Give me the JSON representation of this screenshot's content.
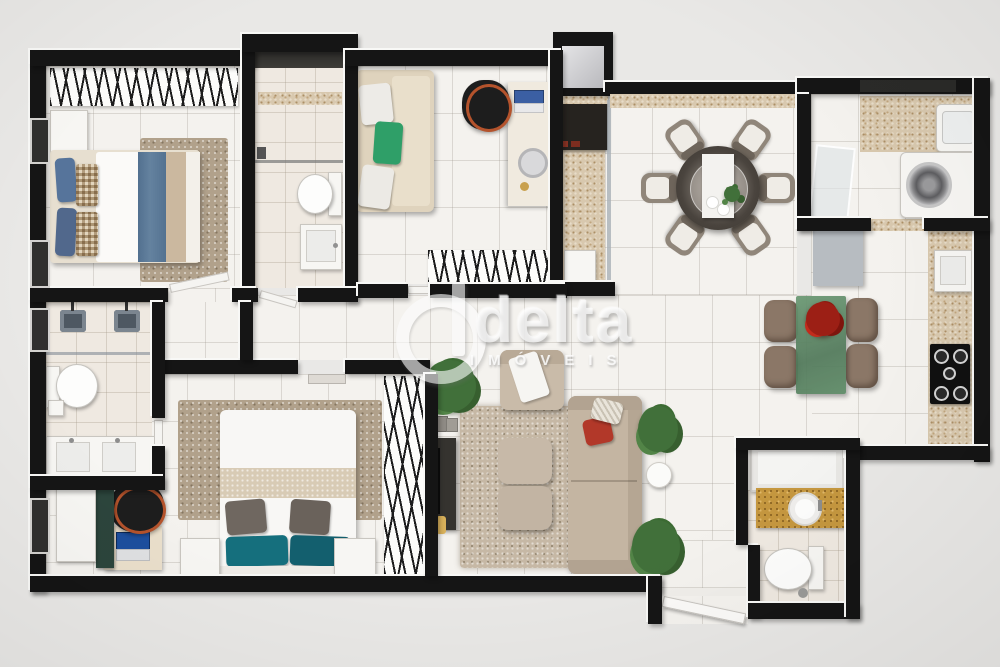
{
  "watermark": {
    "brand": "delta",
    "subtitle": "IMÓVEIS"
  },
  "palette": {
    "background": "#e9e8e6",
    "walls": "#151515",
    "floor_tile": "#f4f2ee",
    "bath_tile": "#efe9e1",
    "granite_counter": "#d8c8ae",
    "wood_vanity": "#c5973f",
    "rug_brown": "#b1a18b",
    "bedding_blue": "#5d7a99",
    "pillow_green": "#2f9f68",
    "pillow_teal": "#156f7d",
    "island_green": "#5d8a66",
    "flowers_red": "#9c1f15",
    "sofa_beige": "#c4b5a2",
    "office_chair_black": "#1d1d1d",
    "chair_strap_orange": "#b4532c"
  },
  "floor_plan": {
    "type": "apartment-3d-top-down-render",
    "rooms": [
      {
        "name": "bedroom-1",
        "furniture": [
          "double-bed-blue-bedding",
          "stick-headboard-panel",
          "wardrobe",
          "shag-rug"
        ]
      },
      {
        "name": "bathroom-1",
        "furniture": [
          "closet-niche",
          "shower",
          "toilet",
          "square-sink"
        ]
      },
      {
        "name": "office-guest-room",
        "furniture": [
          "daybed-sofa-green-pillow",
          "desk-with-laptop",
          "black-office-chair",
          "stick-bench"
        ]
      },
      {
        "name": "gourmet-balcony",
        "furniture": [
          "grill-counter",
          "service-box"
        ]
      },
      {
        "name": "dining-room",
        "furniture": [
          "round-dining-table",
          "six-upholstered-chairs",
          "table-runner",
          "plates",
          "small-plant"
        ]
      },
      {
        "name": "laundry-room",
        "furniture": [
          "washing-machine",
          "tank-sink",
          "granite-counter",
          "glass-door"
        ]
      },
      {
        "name": "kitchen",
        "furniture": [
          "gray-cabinet",
          "granite-counter-with-sink",
          "five-burner-cooktop",
          "green-island-table",
          "four-stools",
          "red-flowers"
        ]
      },
      {
        "name": "living-room",
        "furniture": [
          "armchair-with-throw",
          "long-sofa-red-pillows",
          "two-poufs",
          "shag-rug",
          "tv-console",
          "side-table",
          "three-plants"
        ]
      },
      {
        "name": "master-bedroom",
        "furniture": [
          "double-bed-teal-pillows",
          "two-nightstands",
          "desk-with-laptop",
          "black-office-chair",
          "green-cabinet",
          "white-chest",
          "stick-wall-panel",
          "shag-rug"
        ]
      },
      {
        "name": "ensuite-bathroom",
        "furniture": [
          "double-shower",
          "toilet",
          "double-sink-vanity"
        ]
      },
      {
        "name": "guest-bathroom",
        "furniture": [
          "wood-vanity-vessel-sink",
          "toilet",
          "shower-closet-box"
        ]
      },
      {
        "name": "entry-hall",
        "furniture": [
          "open-entrance-door"
        ]
      }
    ]
  }
}
